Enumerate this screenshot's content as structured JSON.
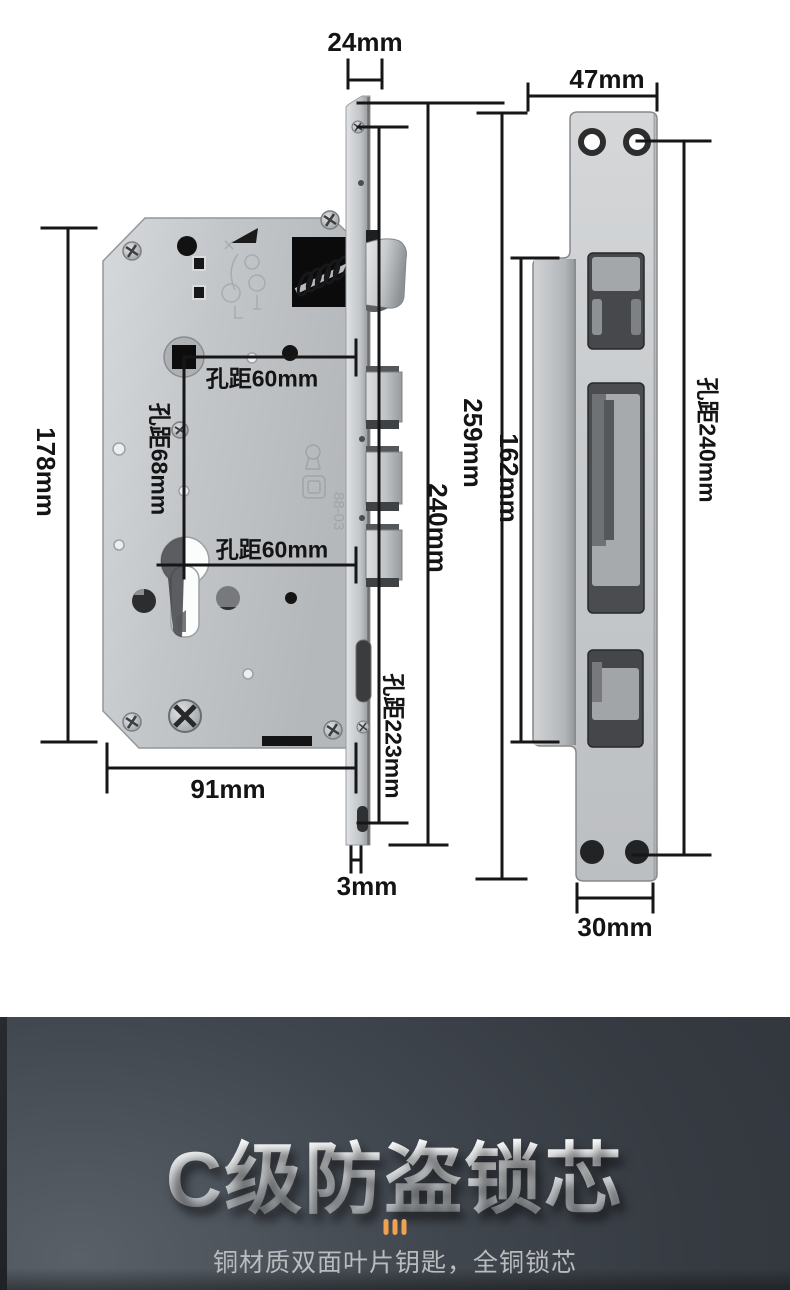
{
  "lock_diagram": {
    "labels": {
      "faceplate_width": "24mm",
      "body_height": "178mm",
      "backset_upper": "孔距60mm",
      "spindle_cylinder_distance": "孔距68mm",
      "backset_lower": "孔距60mm",
      "body_width": "91mm",
      "faceplate_screw_distance": "孔距223mm",
      "faceplate_length": "240mm",
      "overall_length": "259mm",
      "faceplate_thickness": "3mm"
    },
    "etched_marking": "88-03"
  },
  "strike_plate_diagram": {
    "labels": {
      "plate_width": "47mm",
      "lip_length": "162mm",
      "screw_hole_distance": "孔距240mm",
      "bottom_width": "30mm"
    }
  },
  "banner": {
    "title": "C级防盗锁芯",
    "subtitle": "铜材质双面叶片钥匙，全铜锁芯",
    "divider_icon": "three-vertical-bars",
    "colors": {
      "background": "#363b42",
      "accent_orange": "#efa24f",
      "title_silver": "#e9ebed",
      "subtitle_gray": "#b9bbbd"
    }
  }
}
